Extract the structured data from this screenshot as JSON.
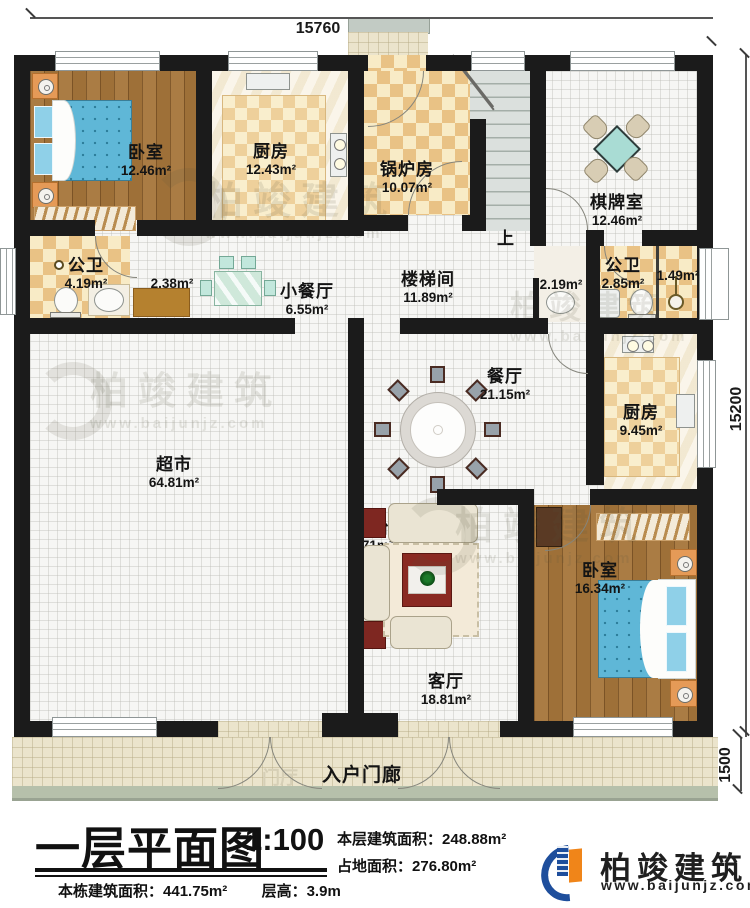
{
  "dimensions": {
    "top": "15760",
    "right": "15200",
    "porch": "1500"
  },
  "stairs": {
    "up_label": "上"
  },
  "rooms": {
    "bedroom1": {
      "name": "卧室",
      "area": "12.46m²"
    },
    "kitchen1": {
      "name": "厨房",
      "area": "12.43m²"
    },
    "boiler": {
      "name": "锅炉房",
      "area": "10.07m²"
    },
    "chess": {
      "name": "棋牌室",
      "area": "12.46m²"
    },
    "bath1": {
      "name": "公卫",
      "area": "4.19m²"
    },
    "closet": {
      "area": "2.38m²"
    },
    "dinette": {
      "name": "小餐厅",
      "area": "6.55m²"
    },
    "stairhall": {
      "name": "楼梯间",
      "area": "11.89m²"
    },
    "washarea": {
      "area": "2.19m²"
    },
    "bath2": {
      "name": "公卫",
      "area": "2.85m²"
    },
    "shower": {
      "area": "1.49m²"
    },
    "dining": {
      "name": "餐厅",
      "area": "21.15m²"
    },
    "kitchen2": {
      "name": "厨房",
      "area": "9.45m²"
    },
    "market": {
      "name": "超市",
      "area": "64.81m²"
    },
    "living": {
      "name": "客厅",
      "area": "18.81m²"
    },
    "balcony": {
      "name": "阳台",
      "area": "3.71m²"
    },
    "bedroom2": {
      "name": "卧室",
      "area": "16.34m²"
    },
    "porch": {
      "name": "入户门廊"
    },
    "foyer_ghost": {
      "name": "门厅"
    }
  },
  "title_block": {
    "title": "一层平面图",
    "scale": "1:100",
    "floor_area_label": "本层建筑面积：",
    "floor_area": "248.88m²",
    "footprint_label": "占地面积：",
    "footprint": "276.80m²",
    "total_area_label": "本栋建筑面积：",
    "total_area": "441.75m²",
    "height_label": "层高：",
    "height": "3.9m"
  },
  "logo": {
    "name": "柏竣建筑",
    "site": "www.baijunjz.com"
  },
  "watermark": {
    "text": "柏竣建筑",
    "site": "www.baijunjz.com"
  },
  "colors": {
    "wall": "#1b1b1b",
    "logo_blue": "#1e4e9c",
    "logo_orange": "#f08519",
    "bed_blue": "#5fb7d7"
  }
}
